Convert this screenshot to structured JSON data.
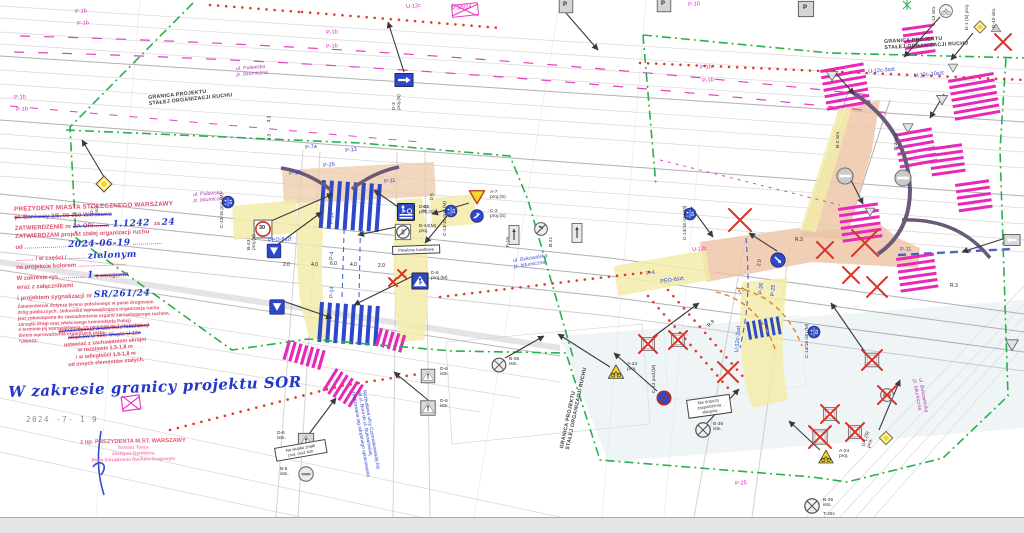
{
  "colors": {
    "stamp_red": "#d73755",
    "hand_blue": "#2338c8",
    "boundary_green": "#2aaf4e",
    "marking_pink": "#e829b8",
    "marking_blue": "#2d49c9",
    "removal_red": "#d8352a",
    "surface_salmon": "#ecc3a4",
    "island_yellow": "#f3ecaa",
    "sign_yellow": "#f8d42a",
    "basemap_gray": "#c3c3c8"
  },
  "boundary": {
    "line1": "GRANICA PROJEKTU",
    "line2": "STAŁEJ ORGANIZACJI RUCHU",
    "positions": [
      {
        "x": 148,
        "y": 96,
        "r": -6
      },
      {
        "x": 884,
        "y": 40,
        "r": -3
      },
      {
        "x": 560,
        "y": 448,
        "r": -78
      }
    ]
  },
  "stamp": {
    "lines": [
      [
        [
          "PREZYDENT MIASTA STOŁECZNEGO WARSZAWY",
          "rb"
        ]
      ],
      [
        [
          "pl. Bankowy 3/5, 00-950 Warszawa",
          "rs"
        ]
      ],
      [
        [
          "ZATWIERDZENIE nr ",
          "r"
        ],
        [
          "ZA-OR/……..",
          "rs"
        ],
        [
          " 1.1242 ",
          "hb"
        ],
        [
          "za ",
          "r"
        ],
        [
          "24",
          "hb"
        ]
      ],
      [
        [
          "ZATWIERDZAM projekt stałej organizacji ruchu",
          "r"
        ]
      ],
      [
        [
          "od ………………… ",
          "r"
        ],
        [
          "2024-06-19",
          "hb"
        ],
        [
          " ……………",
          "r"
        ]
      ],
      [
        [
          "……… / w części / ………  ",
          "r"
        ],
        [
          "zielonym",
          "hb"
        ]
      ],
      [
        [
          "na projekcie kolorem ……………………",
          "r"
        ]
      ],
      [
        [
          "W zakresie rys. ………… ",
          "r"
        ],
        [
          "1",
          "hb"
        ],
        [
          "  z uwagami*",
          "rs"
        ]
      ],
      [
        [
          "wraz z załącznikami",
          "r"
        ]
      ],
      [
        [
          "i projektem sygnalizacji nr ",
          "r"
        ],
        [
          "SR/261/24",
          "hb"
        ]
      ],
      [
        [
          "Zatwierdzenie dotyczy terenu położonego w pasie drogowym",
          "sm"
        ]
      ],
      [
        [
          "dróg publicznych. Jednostka wprowadzająca organizację ruchu",
          "sm"
        ]
      ],
      [
        [
          "jest zobowiązana do zawiadomienia organu zarządzającego ruchem,",
          "sm"
        ]
      ],
      [
        [
          "zarządu drogi oraz właściwego komendanta Policji",
          "sm"
        ]
      ],
      [
        [
          "o terminie jej wprowadzenia, co najmniej na 7 dni przed",
          "sm"
        ]
      ],
      [
        [
          "dniem wprowadzenia organizacji ruchu.",
          "sm"
        ]
      ],
      [
        [
          "*UWAGI:",
          "sm"
        ]
      ]
    ]
  },
  "u12c_note": {
    "lines": [
      [
        "Zatwierdzenie w zakresie lokalizacji",
        1
      ],
      [
        "słupków U-12c. Słupki U-12c",
        1
      ],
      [
        "ustawiać z zachowaniem skrajni",
        0
      ],
      [
        "w rozstawie 1,5-1,8 m",
        0
      ],
      [
        "i w odległości 1,5-1,8 m",
        0
      ],
      [
        "od innych elementów stałych.",
        0
      ]
    ]
  },
  "hand_note": "W zakresie granicy projektu SOR",
  "date_stamp": "2024 -7- 1 9",
  "signer": {
    "line": "z up. PREZYDENTA M.ST. WARSZAWY",
    "sub": [
      "Tomasz Tosza",
      "Zastępca Dyrektora",
      "Biura Zarządzania Ruchem Drogowym"
    ]
  },
  "noteboxes": [
    {
      "t": "Nie dotyczy\nzaopatrzenia sklepów",
      "x": 686,
      "y": 400,
      "w": 38,
      "r": -8
    },
    {
      "t": "Pawilony handlowe",
      "x": 392,
      "y": 246,
      "w": 42,
      "r": -2
    },
    {
      "t": "Na słupku znaki\nproj. oraz istn.",
      "x": 274,
      "y": 448,
      "w": 46,
      "r": -10
    }
  ],
  "labels": [
    {
      "t": "P-1b",
      "x": 75,
      "y": 9,
      "c": "pink",
      "r": -4
    },
    {
      "t": "P-1b",
      "x": 77,
      "y": 21,
      "c": "pink",
      "r": -4
    },
    {
      "t": "P-1b",
      "x": 14,
      "y": 95,
      "c": "pink",
      "r": -4
    },
    {
      "t": "P-1b",
      "x": 16,
      "y": 107,
      "c": "pink",
      "r": -4
    },
    {
      "t": "P-1b",
      "x": 326,
      "y": 30,
      "c": "pink",
      "r": -4
    },
    {
      "t": "P-1b",
      "x": 326,
      "y": 44,
      "c": "pink",
      "r": -4
    },
    {
      "t": "U-12c",
      "x": 406,
      "y": 4,
      "c": "pink",
      "r": -4
    },
    {
      "t": "P-25/24",
      "x": 452,
      "y": 6,
      "c": "pink",
      "r": -6
    },
    {
      "t": "P-1b",
      "x": 700,
      "y": 65,
      "c": "pink",
      "r": -4
    },
    {
      "t": "P-1b",
      "x": 702,
      "y": 78,
      "c": "pink",
      "r": -4
    },
    {
      "t": "U-12c",
      "x": 692,
      "y": 247,
      "c": "pink",
      "r": -4
    },
    {
      "t": "P-25",
      "x": 735,
      "y": 481,
      "c": "pink",
      "r": -4
    },
    {
      "t": "P-10",
      "x": 688,
      "y": 2,
      "c": "pink",
      "r": -4
    },
    {
      "t": "ul. Puławska\njz. bitumiczna",
      "x": 193,
      "y": 193,
      "c": "street",
      "s": 5.2,
      "r": -4
    },
    {
      "t": "ul. Puławska\njz. bitumiczna",
      "x": 236,
      "y": 67,
      "c": "street",
      "s": 5.2,
      "r": -4
    },
    {
      "t": "ul. Bukowińska\njz. bitumiczna",
      "x": 513,
      "y": 259,
      "c": "bstreet",
      "s": 5.2,
      "r": -8
    },
    {
      "t": "ul. Bukowińska\njz. bitumiczna",
      "x": 922,
      "y": 378,
      "c": "street",
      "s": 5.2,
      "r": 80
    },
    {
      "t": "P-7a",
      "x": 305,
      "y": 145,
      "c": "blue",
      "r": -6
    },
    {
      "t": "P-13",
      "x": 345,
      "y": 148,
      "c": "blue",
      "r": -6
    },
    {
      "t": "P-25",
      "x": 323,
      "y": 163,
      "c": "blue",
      "r": -6
    },
    {
      "t": "P-11",
      "x": 384,
      "y": 179,
      "c": "blue",
      "r": -6
    },
    {
      "t": "P-10",
      "x": 289,
      "y": 171,
      "c": "blue",
      "r": -6
    },
    {
      "t": "P-26",
      "x": 369,
      "y": 190,
      "c": "blue",
      "r": -6
    },
    {
      "t": "PEO-6szt",
      "x": 268,
      "y": 238,
      "c": "blue",
      "r": -4
    },
    {
      "t": "P-14",
      "x": 329,
      "y": 224,
      "c": "blue",
      "r": -88
    },
    {
      "t": "P-4",
      "x": 329,
      "y": 260,
      "c": "blue",
      "r": -88
    },
    {
      "t": "P-14",
      "x": 329,
      "y": 298,
      "c": "blue",
      "r": -88
    },
    {
      "t": "P-4",
      "x": 646,
      "y": 271,
      "c": "blue",
      "r": -8
    },
    {
      "t": "PEO-6szt",
      "x": 660,
      "y": 279,
      "c": "blue",
      "r": -8
    },
    {
      "t": "P-26",
      "x": 758,
      "y": 294,
      "c": "blue",
      "r": -85
    },
    {
      "t": "P-25",
      "x": 770,
      "y": 296,
      "c": "blue",
      "r": -85
    },
    {
      "t": "U-12c-2szt",
      "x": 734,
      "y": 352,
      "c": "blue",
      "r": -85
    },
    {
      "t": "U-12c-3szt",
      "x": 868,
      "y": 69,
      "c": "blue",
      "r": -5
    },
    {
      "t": "U-12c-10szt",
      "x": 914,
      "y": 73,
      "c": "blue",
      "r": -5
    },
    {
      "t": "P-11",
      "x": 900,
      "y": 247,
      "c": "blue",
      "r": -3
    },
    {
      "t": "Rozbudowa ulicy Czerniakowskiej-bis\nod ul. Bora do ul. Bukowińskiej\nrealizowana wg odrębnego opracowania",
      "x": 366,
      "y": 390,
      "c": "blue",
      "s": 4.8,
      "r": 80
    },
    {
      "t": "2.0",
      "x": 283,
      "y": 263,
      "c": "dim",
      "s": 5
    },
    {
      "t": "4.0",
      "x": 311,
      "y": 263,
      "c": "dim",
      "s": 5
    },
    {
      "t": "6.0",
      "x": 330,
      "y": 262,
      "c": "dim",
      "s": 5
    },
    {
      "t": "4.0",
      "x": 350,
      "y": 263,
      "c": "dim",
      "s": 5
    },
    {
      "t": "2.0",
      "x": 378,
      "y": 264,
      "c": "dim",
      "s": 5
    },
    {
      "t": "0.5",
      "x": 430,
      "y": 200,
      "c": "dim",
      "s": 5,
      "r": -85
    },
    {
      "t": "4.0",
      "x": 423,
      "y": 212,
      "c": "dim",
      "s": 5,
      "r": -85
    },
    {
      "t": "3.3",
      "x": 266,
      "y": 122,
      "c": "dim",
      "s": 4.6,
      "r": -85
    },
    {
      "t": "3.3",
      "x": 266,
      "y": 140,
      "c": "dim",
      "s": 4.6,
      "r": -85
    },
    {
      "t": "R.3",
      "x": 795,
      "y": 238,
      "c": "dim",
      "s": 5
    },
    {
      "t": "2.0",
      "x": 757,
      "y": 266,
      "c": "dim",
      "s": 5,
      "r": -80
    },
    {
      "t": "7.5",
      "x": 738,
      "y": 292,
      "c": "dim",
      "s": 5,
      "r": -45
    },
    {
      "t": "R.9",
      "x": 707,
      "y": 325,
      "c": "dim",
      "s": 5,
      "r": -45
    },
    {
      "t": "R.3",
      "x": 950,
      "y": 284,
      "c": "dim",
      "s": 5
    },
    {
      "t": "D-1\nproj.",
      "x": 90,
      "y": 214,
      "c": "dark",
      "s": 4.8,
      "r": -90
    },
    {
      "t": "B-43\nproj.(S)",
      "x": 247,
      "y": 250,
      "c": "dark",
      "s": 4.8,
      "r": -90
    },
    {
      "t": "D-6b\nproj.(S)",
      "x": 419,
      "y": 205,
      "c": "dark",
      "s": 4.8
    },
    {
      "t": "B-44(M)\nproj.",
      "x": 419,
      "y": 224,
      "c": "dark",
      "s": 4.8
    },
    {
      "t": "A-7\nproj.(S)",
      "x": 490,
      "y": 190,
      "c": "dark",
      "s": 4.8
    },
    {
      "t": "C-2\nproj.(S)",
      "x": 490,
      "y": 209,
      "c": "dark",
      "s": 4.8
    },
    {
      "t": "C-13/16 proj.(M)",
      "x": 443,
      "y": 236,
      "c": "dark",
      "s": 4.8,
      "r": -90
    },
    {
      "t": "C-13/16 proj.(M)",
      "x": 220,
      "y": 228,
      "c": "dark",
      "s": 4.8,
      "r": -90
    },
    {
      "t": "F-19",
      "x": 506,
      "y": 247,
      "c": "dark",
      "s": 4.8,
      "r": -90
    },
    {
      "t": "B-21",
      "x": 549,
      "y": 247,
      "c": "dark",
      "s": 4.8,
      "r": -90
    },
    {
      "t": "D-3\nproj.(S)",
      "x": 392,
      "y": 110,
      "c": "dark",
      "s": 4.8,
      "r": -90
    },
    {
      "t": "D-6\nproj.(M)",
      "x": 431,
      "y": 271,
      "c": "dark",
      "s": 4.8
    },
    {
      "t": "D-6\nistn.",
      "x": 440,
      "y": 399,
      "c": "dark",
      "s": 4.8
    },
    {
      "t": "D-6\nistn.",
      "x": 440,
      "y": 367,
      "c": "dark",
      "s": 4.8
    },
    {
      "t": "B-36\nistn.",
      "x": 509,
      "y": 357,
      "c": "dark",
      "s": 4.8
    },
    {
      "t": "D-6\nistn.",
      "x": 277,
      "y": 431,
      "c": "dark",
      "s": 4.8
    },
    {
      "t": "B-5\nistn.",
      "x": 280,
      "y": 467,
      "c": "dark",
      "s": 4.8
    },
    {
      "t": "A-24\nproj.",
      "x": 627,
      "y": 362,
      "c": "dark",
      "s": 4.8
    },
    {
      "t": "C-13 pod.(M)",
      "x": 652,
      "y": 393,
      "c": "dark",
      "s": 4.8,
      "r": -90
    },
    {
      "t": "B-36\nistn.",
      "x": 713,
      "y": 422,
      "c": "dark",
      "s": 4.8
    },
    {
      "t": "A-24\nproj.",
      "x": 839,
      "y": 449,
      "c": "dark",
      "s": 4.8
    },
    {
      "t": "B-36\nistn.",
      "x": 823,
      "y": 498,
      "c": "dark",
      "s": 4.8
    },
    {
      "t": "T-25c",
      "x": 823,
      "y": 512,
      "c": "dark",
      "s": 4.8
    },
    {
      "t": "D-1 (S)\nproj.",
      "x": 862,
      "y": 446,
      "c": "dark",
      "s": 4.8,
      "r": -75
    },
    {
      "t": "C-13 istn.",
      "x": 932,
      "y": 26,
      "c": "dark",
      "s": 4.8,
      "r": -90
    },
    {
      "t": "D-1 (S) proj.",
      "x": 965,
      "y": 30,
      "c": "dark",
      "s": 4.8,
      "r": -90
    },
    {
      "t": "D-4b istn.",
      "x": 992,
      "y": 28,
      "c": "dark",
      "s": 4.8,
      "r": -90
    },
    {
      "t": "B-2 istn.",
      "x": 836,
      "y": 148,
      "c": "dark",
      "s": 4.8,
      "r": -90
    },
    {
      "t": "B-2 istn.",
      "x": 894,
      "y": 150,
      "c": "dark",
      "s": 4.8,
      "r": -90
    },
    {
      "t": "C-13/16 istn.(M)",
      "x": 683,
      "y": 240,
      "c": "dark",
      "s": 4.8,
      "r": -90
    },
    {
      "t": "C-13/16 istn.(M)",
      "x": 805,
      "y": 358,
      "c": "dark",
      "s": 4.8,
      "r": -90
    },
    {
      "t": "30",
      "x": 259,
      "y": 225,
      "c": "dark",
      "s": 5.5,
      "b": 1
    },
    {
      "t": "P",
      "x": 563,
      "y": 2,
      "c": "dark",
      "s": 6,
      "b": 1
    },
    {
      "t": "P",
      "x": 661,
      "y": 1,
      "c": "dark",
      "s": 6,
      "b": 1
    },
    {
      "t": "P",
      "x": 803,
      "y": 5,
      "c": "dark",
      "s": 6,
      "b": 1
    }
  ],
  "signs": [
    {
      "k": "d1",
      "x": 104,
      "y": 184,
      "s": 0.9
    },
    {
      "k": "d1",
      "x": 886,
      "y": 438,
      "s": 0.75
    },
    {
      "k": "d1",
      "x": 980,
      "y": 27,
      "s": 0.7
    },
    {
      "k": "s30",
      "x": 263,
      "y": 229,
      "s": 1.05
    },
    {
      "k": "p15",
      "x": 274,
      "y": 251,
      "s": 0.8
    },
    {
      "k": "p15",
      "x": 277,
      "y": 307,
      "s": 0.85
    },
    {
      "k": "d6b",
      "x": 406,
      "y": 212,
      "s": 1
    },
    {
      "k": "b44",
      "x": 403,
      "y": 232,
      "s": 0.9
    },
    {
      "k": "a7y",
      "x": 477,
      "y": 197,
      "s": 0.9
    },
    {
      "k": "c2",
      "x": 477,
      "y": 216,
      "s": 0.75
    },
    {
      "k": "c1316",
      "x": 451,
      "y": 211,
      "s": 0.7
    },
    {
      "k": "c1316",
      "x": 228,
      "y": 202,
      "s": 0.7
    },
    {
      "k": "c1316",
      "x": 690,
      "y": 214,
      "s": 0.7
    },
    {
      "k": "c1316",
      "x": 814,
      "y": 332,
      "s": 0.7
    },
    {
      "k": "c9",
      "x": 778,
      "y": 260,
      "s": 0.85
    },
    {
      "k": "d3",
      "x": 404,
      "y": 80,
      "s": 1
    },
    {
      "k": "f19",
      "x": 514,
      "y": 235,
      "s": 1
    },
    {
      "k": "f19",
      "x": 577,
      "y": 233,
      "s": 1
    },
    {
      "k": "b21",
      "x": 541,
      "y": 229,
      "s": 0.75
    },
    {
      "k": "d6m",
      "x": 420,
      "y": 281,
      "s": 0.95
    },
    {
      "k": "d6g",
      "x": 306,
      "y": 441,
      "s": 0.9
    },
    {
      "k": "d6g",
      "x": 428,
      "y": 376,
      "s": 0.8
    },
    {
      "k": "d6g",
      "x": 428,
      "y": 408,
      "s": 0.85
    },
    {
      "k": "b36",
      "x": 499,
      "y": 365,
      "s": 0.85
    },
    {
      "k": "b36",
      "x": 703,
      "y": 430,
      "s": 0.9
    },
    {
      "k": "b36",
      "x": 812,
      "y": 506,
      "s": 0.9
    },
    {
      "k": "b35",
      "x": 664,
      "y": 398,
      "s": 0.8
    },
    {
      "k": "a24",
      "x": 616,
      "y": 372,
      "s": 0.9
    },
    {
      "k": "a24",
      "x": 826,
      "y": 457,
      "s": 0.85
    },
    {
      "k": "a7g",
      "x": 832,
      "y": 76,
      "s": 0.7
    },
    {
      "k": "a7g",
      "x": 942,
      "y": 100,
      "s": 0.7
    },
    {
      "k": "a7g",
      "x": 908,
      "y": 128,
      "s": 0.65
    },
    {
      "k": "a7g",
      "x": 1012,
      "y": 345,
      "s": 0.8
    },
    {
      "k": "a7g",
      "x": 870,
      "y": 212,
      "s": 0.6
    },
    {
      "k": "a7g",
      "x": 953,
      "y": 68,
      "s": 0.6
    },
    {
      "k": "b2",
      "x": 845,
      "y": 176,
      "s": 0.95
    },
    {
      "k": "b2",
      "x": 903,
      "y": 178,
      "s": 0.95
    },
    {
      "k": "c13g",
      "x": 946,
      "y": 11,
      "s": 0.75
    },
    {
      "k": "gtri",
      "x": 996,
      "y": 28,
      "s": 0.6
    },
    {
      "k": "d18",
      "x": 566,
      "y": 6,
      "s": 0.8
    },
    {
      "k": "d18",
      "x": 664,
      "y": 5,
      "s": 0.8
    },
    {
      "k": "d18",
      "x": 806,
      "y": 9,
      "s": 0.9
    },
    {
      "k": "gsq",
      "x": 648,
      "y": 344,
      "s": 0.8
    },
    {
      "k": "gsq",
      "x": 678,
      "y": 340,
      "s": 0.8
    },
    {
      "k": "gsq",
      "x": 872,
      "y": 360,
      "s": 0.85
    },
    {
      "k": "gsq",
      "x": 830,
      "y": 414,
      "s": 0.8
    },
    {
      "k": "gsq",
      "x": 855,
      "y": 432,
      "s": 0.8
    },
    {
      "k": "gsq",
      "x": 820,
      "y": 437,
      "s": 0.9
    },
    {
      "k": "gcirc",
      "x": 887,
      "y": 395,
      "s": 0.8
    },
    {
      "k": "gcirc",
      "x": 306,
      "y": 474,
      "s": 0.9
    },
    {
      "k": "garrow",
      "x": 1012,
      "y": 240,
      "s": 0.9
    }
  ]
}
